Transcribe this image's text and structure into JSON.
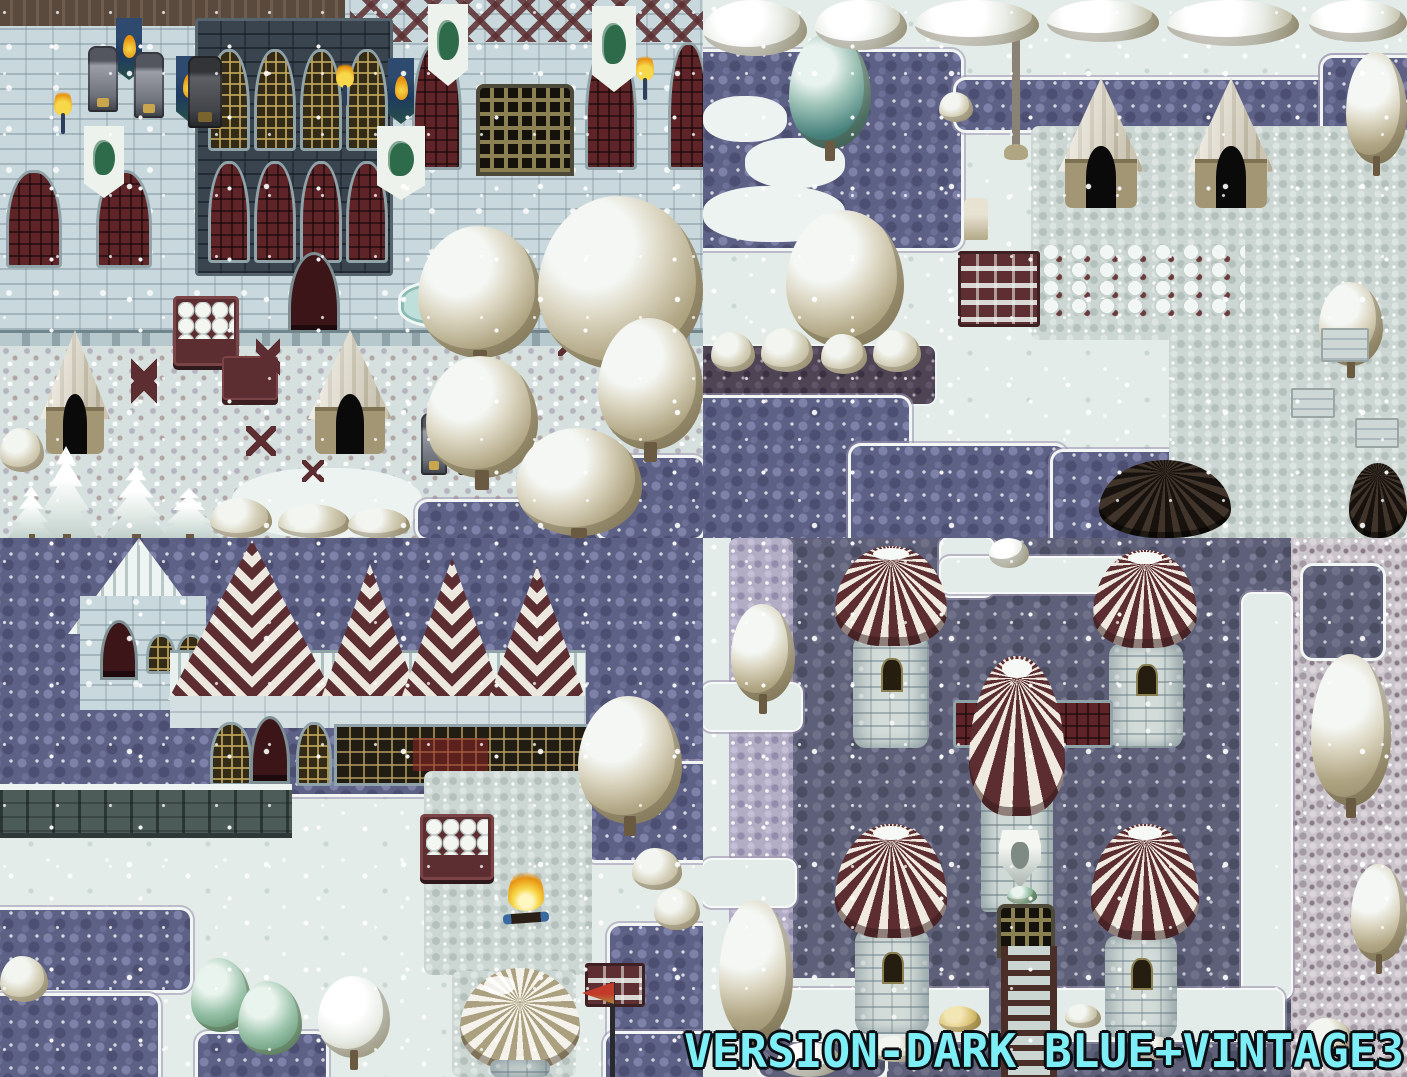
{
  "caption": {
    "text": "VERSION-DARK BLUE+VINTAGE3"
  },
  "palette": {
    "snow": "#e3ece9",
    "snowShadow": "#c6d6d4",
    "cobbleDark": "#5e6186",
    "cobbleSlate": "#5d6078",
    "cobbleLight": "#ccd6d3",
    "pebbleLight": "#cac4cb",
    "lavender": "#b2adc4",
    "wallStone": "#c9d8dc",
    "wallDark": "#39444e",
    "roofMaroon": "#5c2e31",
    "windowMaroon": "#5e2428",
    "latticeGold": "#b09a5c",
    "woodDark": "#4a2e28",
    "treeKhaki": "#b1a684",
    "tealTree": "#47817c",
    "pineGreen": "#47684f",
    "tentCream": "#f0ebdd",
    "tentTan": "#a29674",
    "flameOrange": "#e8920f",
    "flameYellow": "#f6d84a",
    "emberBlue": "#3a6aa0",
    "bannerWhite": "#eef2ec",
    "bannerGreen": "#2e6b4a",
    "fenceTeal": "#4e5c59",
    "waterTeal": "#bfe0da",
    "captionCyan": "#7deef6",
    "captionOutline": "#0b0f14"
  }
}
